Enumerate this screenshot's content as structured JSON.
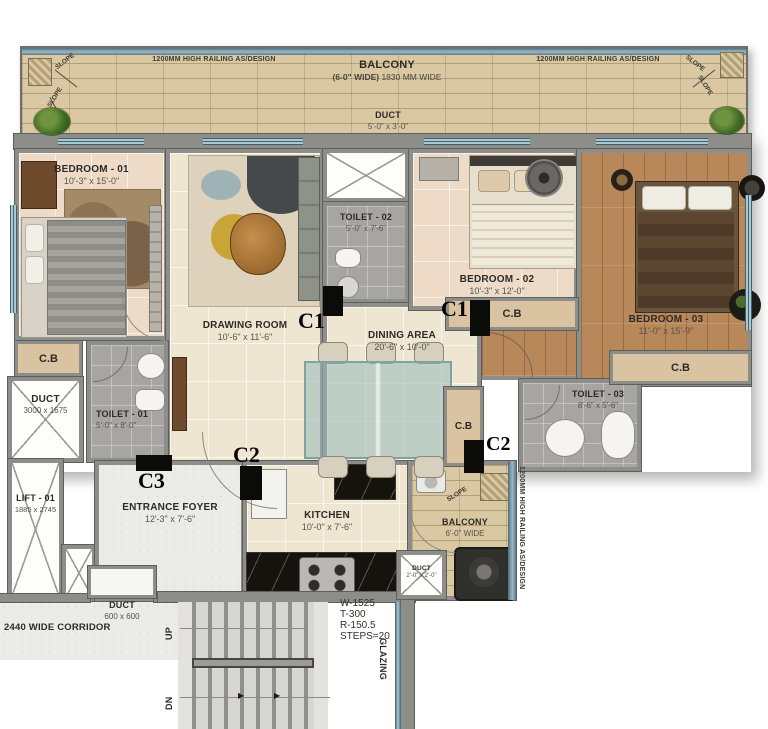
{
  "colors": {
    "wall": "#8d8d8a",
    "balcony_tile": "#d9c8a1",
    "floor_cream": "#efe6d2",
    "floor_pink": "#eddbc8",
    "floor_wood": "#b8875a",
    "toilet_gray": "#a6a5a1",
    "cb_fill": "#d9c3a1",
    "window_blue": "#a9c9d3",
    "column_black": "#0b0b0a",
    "counter_black": "#16130e"
  },
  "balcony_top": {
    "name": "BALCONY",
    "dim_bold": "(6-0\" WIDE)",
    "dim_rest": "1830 MM WIDE",
    "railing": "1200MM HIGH RAILING AS/DESIGN",
    "slope": "SLOPE"
  },
  "rooms": {
    "duct_top": {
      "name": "DUCT",
      "dim": "5'-0\" x 3'-0\""
    },
    "bedroom1": {
      "name": "BEDROOM - 01",
      "dim": "10'-3\" x 15'-0\""
    },
    "bedroom2": {
      "name": "BEDROOM - 02",
      "dim": "10'-3\" x 12'-0\""
    },
    "bedroom3": {
      "name": "BEDROOM - 03",
      "dim": "11'-0\" x 15'-9\""
    },
    "drawing_room": {
      "name": "DRAWING ROOM",
      "dim": "10'-6\" x 11'-6\""
    },
    "dining_area": {
      "name": "DINING AREA",
      "dim": "20'-6\" x 10'-0\""
    },
    "toilet1": {
      "name": "TOILET - 01",
      "dim": "5'-0\" x 8'-0\""
    },
    "toilet2": {
      "name": "TOILET - 02",
      "dim": "5'-0\" x 7'-6\""
    },
    "toilet3": {
      "name": "TOILET - 03",
      "dim": "8'-6\" x 5'-6\""
    },
    "duct_left": {
      "name": "DUCT",
      "dim": "3000 x 1675"
    },
    "lift": {
      "name": "LIFT - 01",
      "dim": "1885 x 2745"
    },
    "entrance_foyer": {
      "name": "ENTRANCE FOYER",
      "dim": "12'-3\" x 7'-6\""
    },
    "kitchen": {
      "name": "KITCHEN",
      "dim": "10'-0\" x 7'-6\""
    },
    "balcony_side": {
      "name": "BALCONY",
      "dim": "6'-0\" WIDE"
    },
    "duct_kitchen": {
      "name": "DUCT",
      "dim": "2'-0\" x 2'-0\""
    },
    "duct_bottom": {
      "name": "DUCT",
      "dim": "600 x 600"
    },
    "corridor": {
      "name": "2440 WIDE CORRIDOR"
    }
  },
  "markers": {
    "c1": "C1",
    "c2": "C2",
    "c3": "C3",
    "cb": "C.B"
  },
  "stairs": {
    "up": "UP",
    "dn": "DN",
    "spec1": "W-1525",
    "spec2": "T-300",
    "spec3": "R-150.5",
    "spec4": "STEPS=20",
    "glazing": "GLAZING"
  },
  "railing_side": "1200MM HIGH RAILING AS/DESIGN"
}
